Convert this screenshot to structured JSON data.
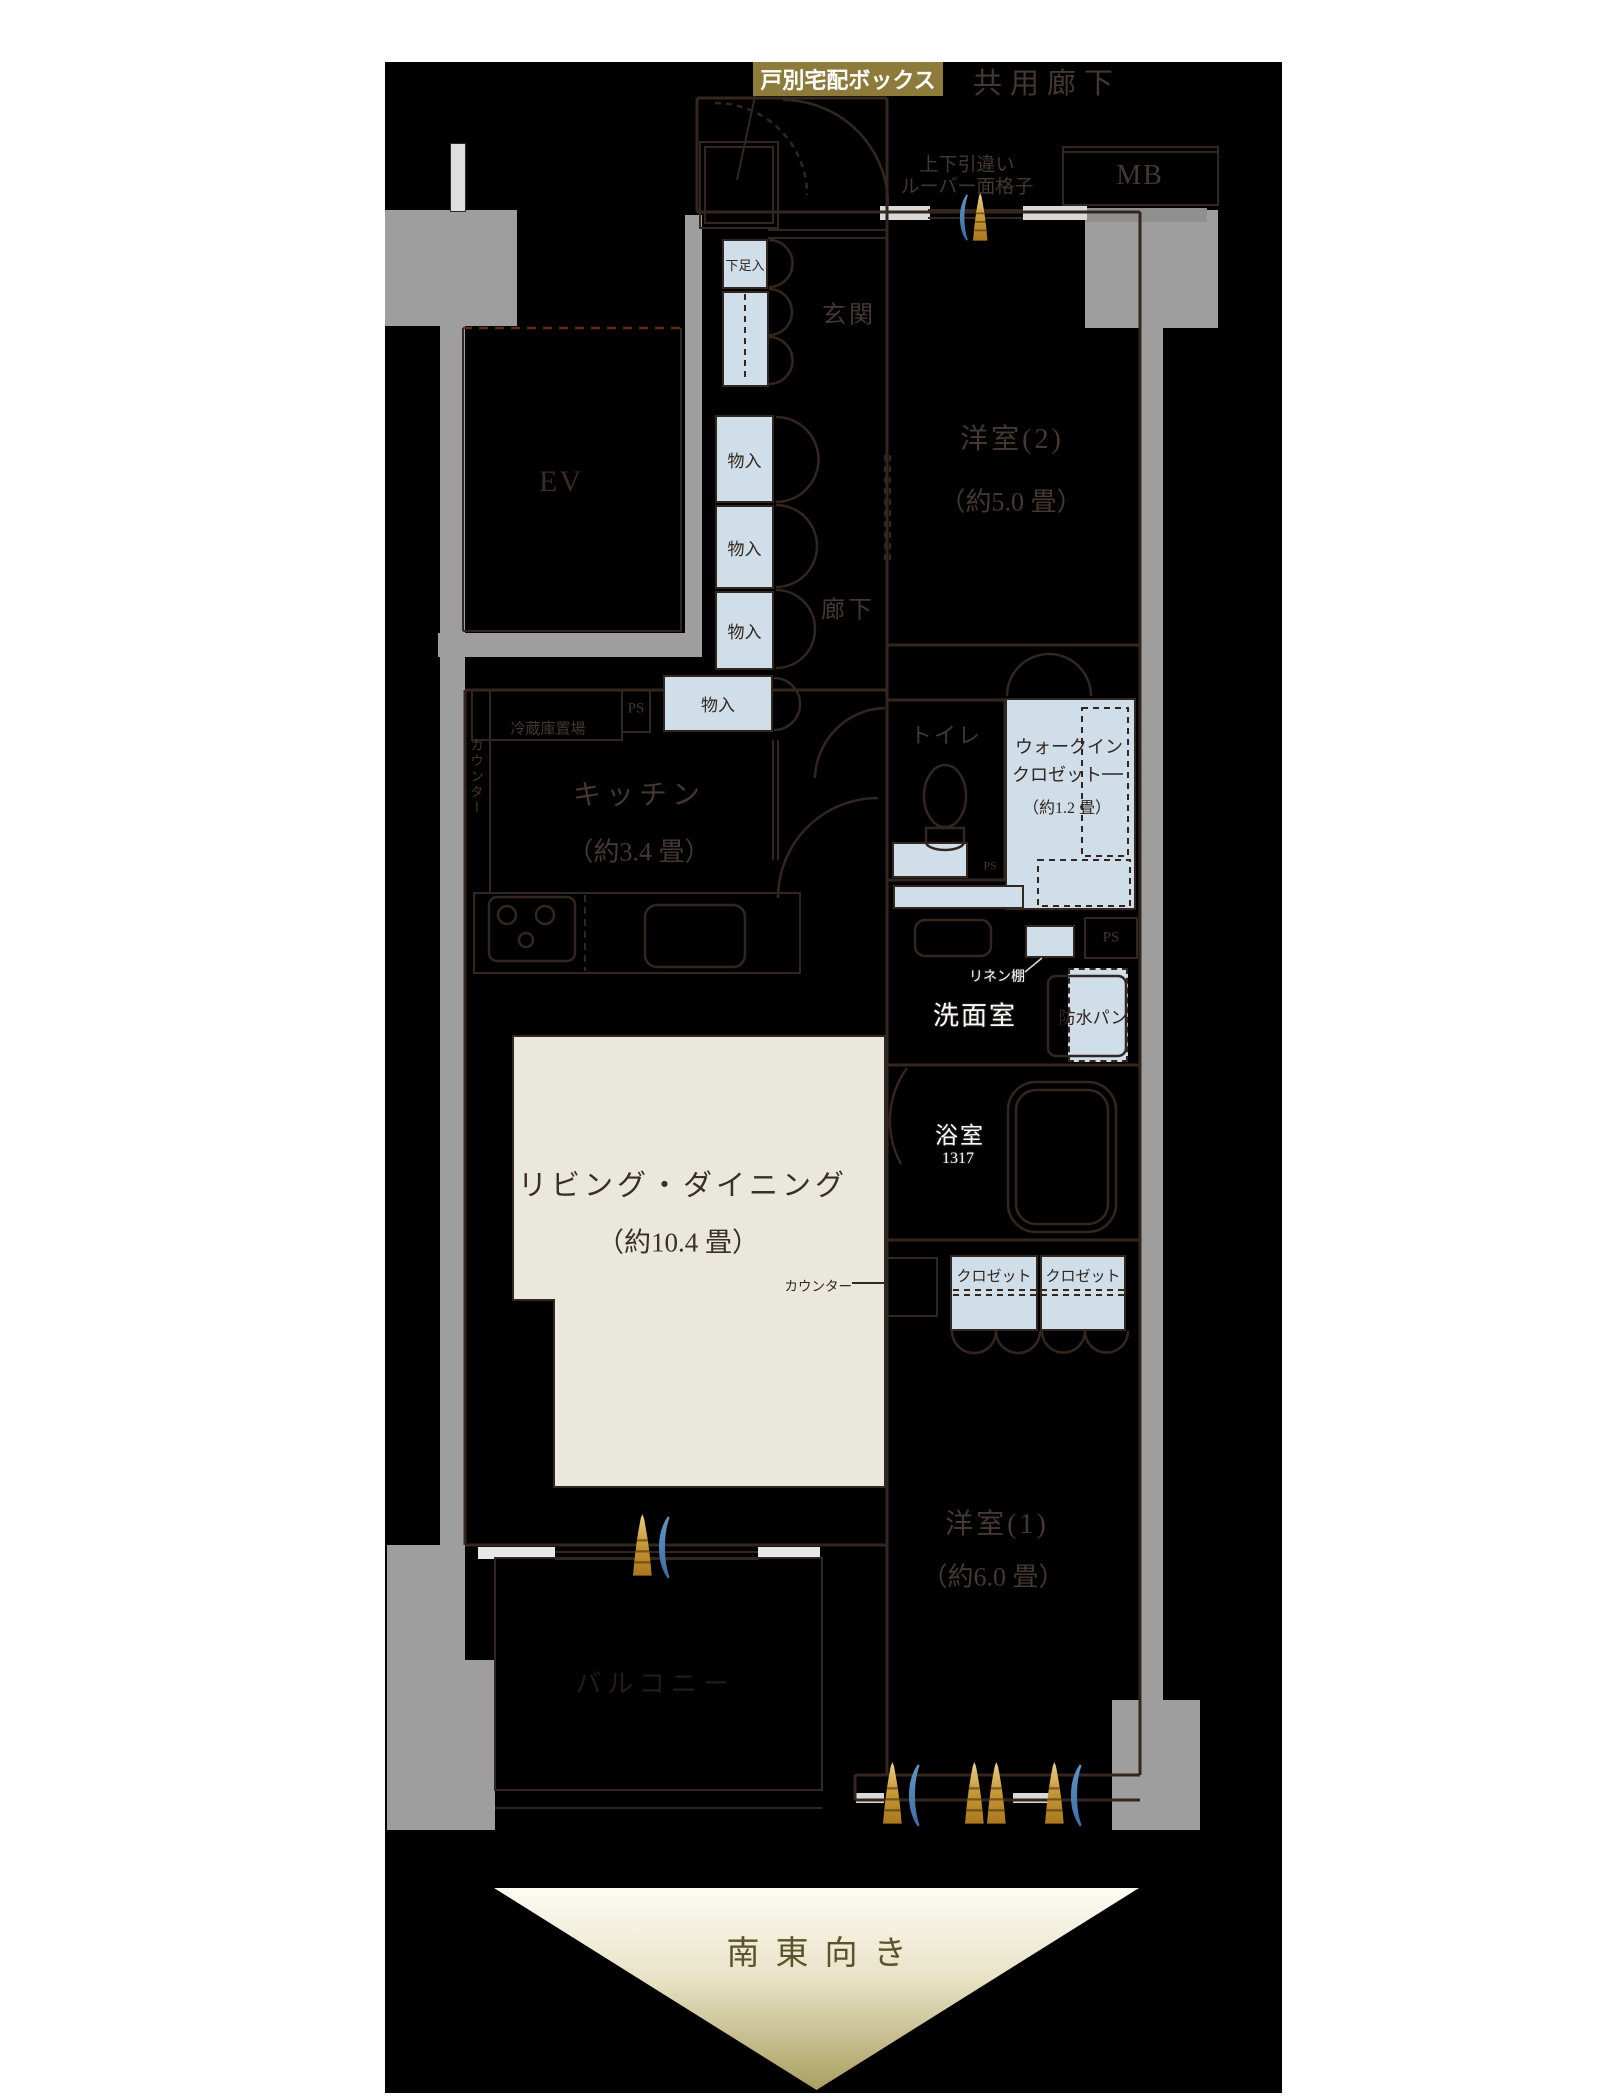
{
  "colors": {
    "canvas": "#000000",
    "wall_gray": "#9e9e9e",
    "fixture_blue": "#cfdee9",
    "living_beige": "#eae8dd",
    "line_brown": "#33261e",
    "label_brown": "#453731",
    "tag_gold_bg": "#8d7b3c",
    "symbol_gold": "#c79734",
    "symbol_blue": "#4a83b8",
    "arrow_text": "#5a532b"
  },
  "annotations": {
    "delivery_box": "戸別宅配ボックス",
    "common_corridor": "共用廊下",
    "meter_box": "MB",
    "louver_line1": "上下引違い",
    "louver_line2": "ルーバー面格子",
    "direction": "南東向き"
  },
  "rooms": {
    "entrance": "玄関",
    "corridor": "廊下",
    "elevator": "EV",
    "bedroom2": "洋室(2)",
    "bedroom2_size": "（約5.0 畳）",
    "kitchen": "キッチン",
    "kitchen_size": "（約3.4 畳）",
    "living": "リビング・ダイニング",
    "living_size": "（約10.4 畳）",
    "bedroom1": "洋室(1)",
    "bedroom1_size": "（約6.0 畳）",
    "toilet": "トイレ",
    "washroom": "洗面室",
    "bathroom": "浴室",
    "bathroom_size": "1317",
    "wic_line1": "ウォークイン",
    "wic_line2": "クロゼット",
    "wic_size": "（約1.2 畳）",
    "balcony": "バルコニー"
  },
  "fixtures": {
    "shoe_box": "下足入",
    "storage": "物入",
    "fridge_space": "冷蔵庫置場",
    "counter": "カウンター",
    "linen_shelf": "リネン棚",
    "waterproof_pan": "防水パン",
    "closet": "クロゼット",
    "pipe_space": "PS"
  }
}
